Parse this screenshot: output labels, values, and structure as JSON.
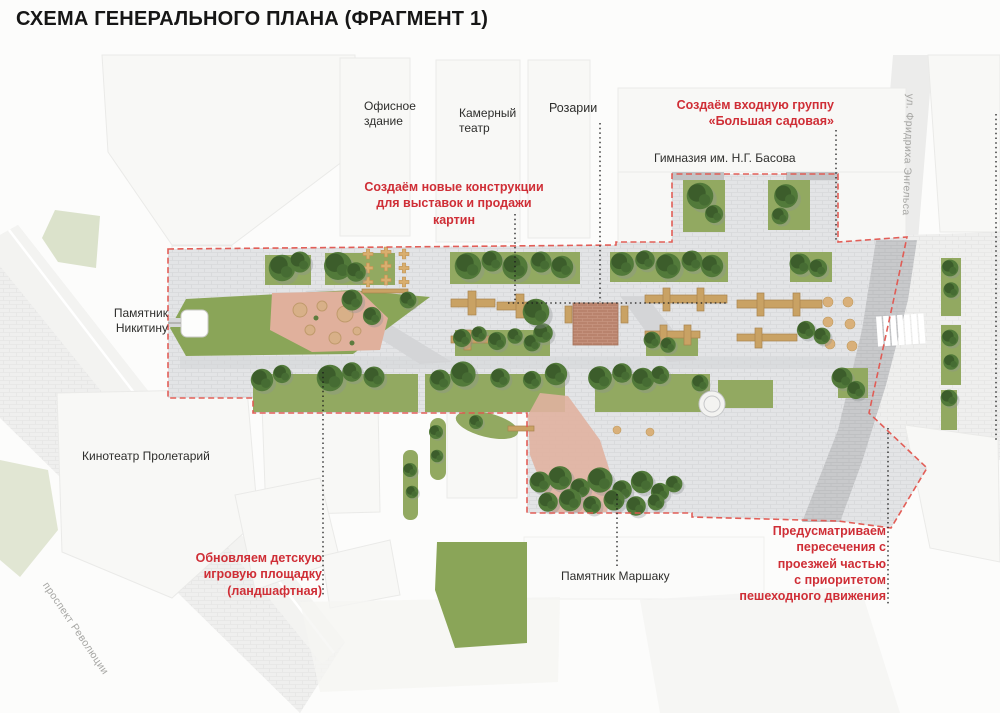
{
  "title": "СХЕМА ГЕНЕРАЛЬНОГО ПЛАНА (ФРАГМЕНТ 1)",
  "map": {
    "places": {
      "office_building": "Офисное\nздание",
      "chamber_theater": "Камерный\nтеатр",
      "rosaries": "Розарии",
      "gymnasium": "Гимназия им. Н.Г. Басова",
      "nikitin_monument": "Памятник\nНикитину",
      "proletariy_cinema": "Кинотеатр Пролетарий",
      "marshak_monument": "Памятник Маршаку"
    },
    "streets": {
      "engels": "ул. Фридриха Энгельса",
      "revolution": "проспект Революции"
    },
    "annotations": {
      "entrance_group": "Создаём входную группу\n«Большая садовая»",
      "art_constructions": "Создаём новые конструкции\nдля выставок и продажи картин",
      "playground": "Обновляем детскую\nигровую площадку\n(ландшафтная)",
      "crossings": "Предусматриваем\nпересечения с\nпроезжей частью\nс приоритетом\nпешеходного движения"
    },
    "colors": {
      "annotation_red": "#cf2e36",
      "boundary_red": "#e2564f",
      "label_black": "#2e2e2c",
      "street_gray": "#a6a6a3",
      "paving": "#e3e4e6",
      "road": "#c8c9cb",
      "lawn": "#92a961",
      "tree": "#3c5d2b",
      "wood": "#c9a264",
      "pink_area": "#e0b1a0",
      "red_square": "#b9836d"
    }
  }
}
